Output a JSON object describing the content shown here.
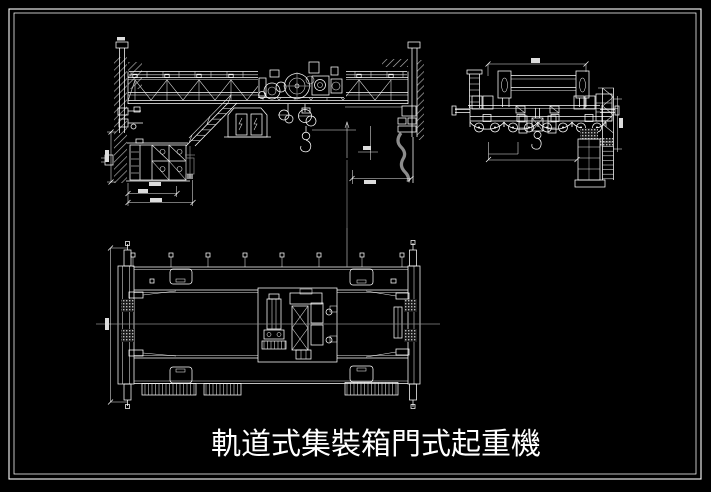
{
  "title": {
    "text": "軌道式集裝箱門式起重機"
  },
  "colors": {
    "background": "#000000",
    "line": "#ffffff",
    "dim_line": "#8c8c8c",
    "hatch": "#b5b5b5"
  }
}
